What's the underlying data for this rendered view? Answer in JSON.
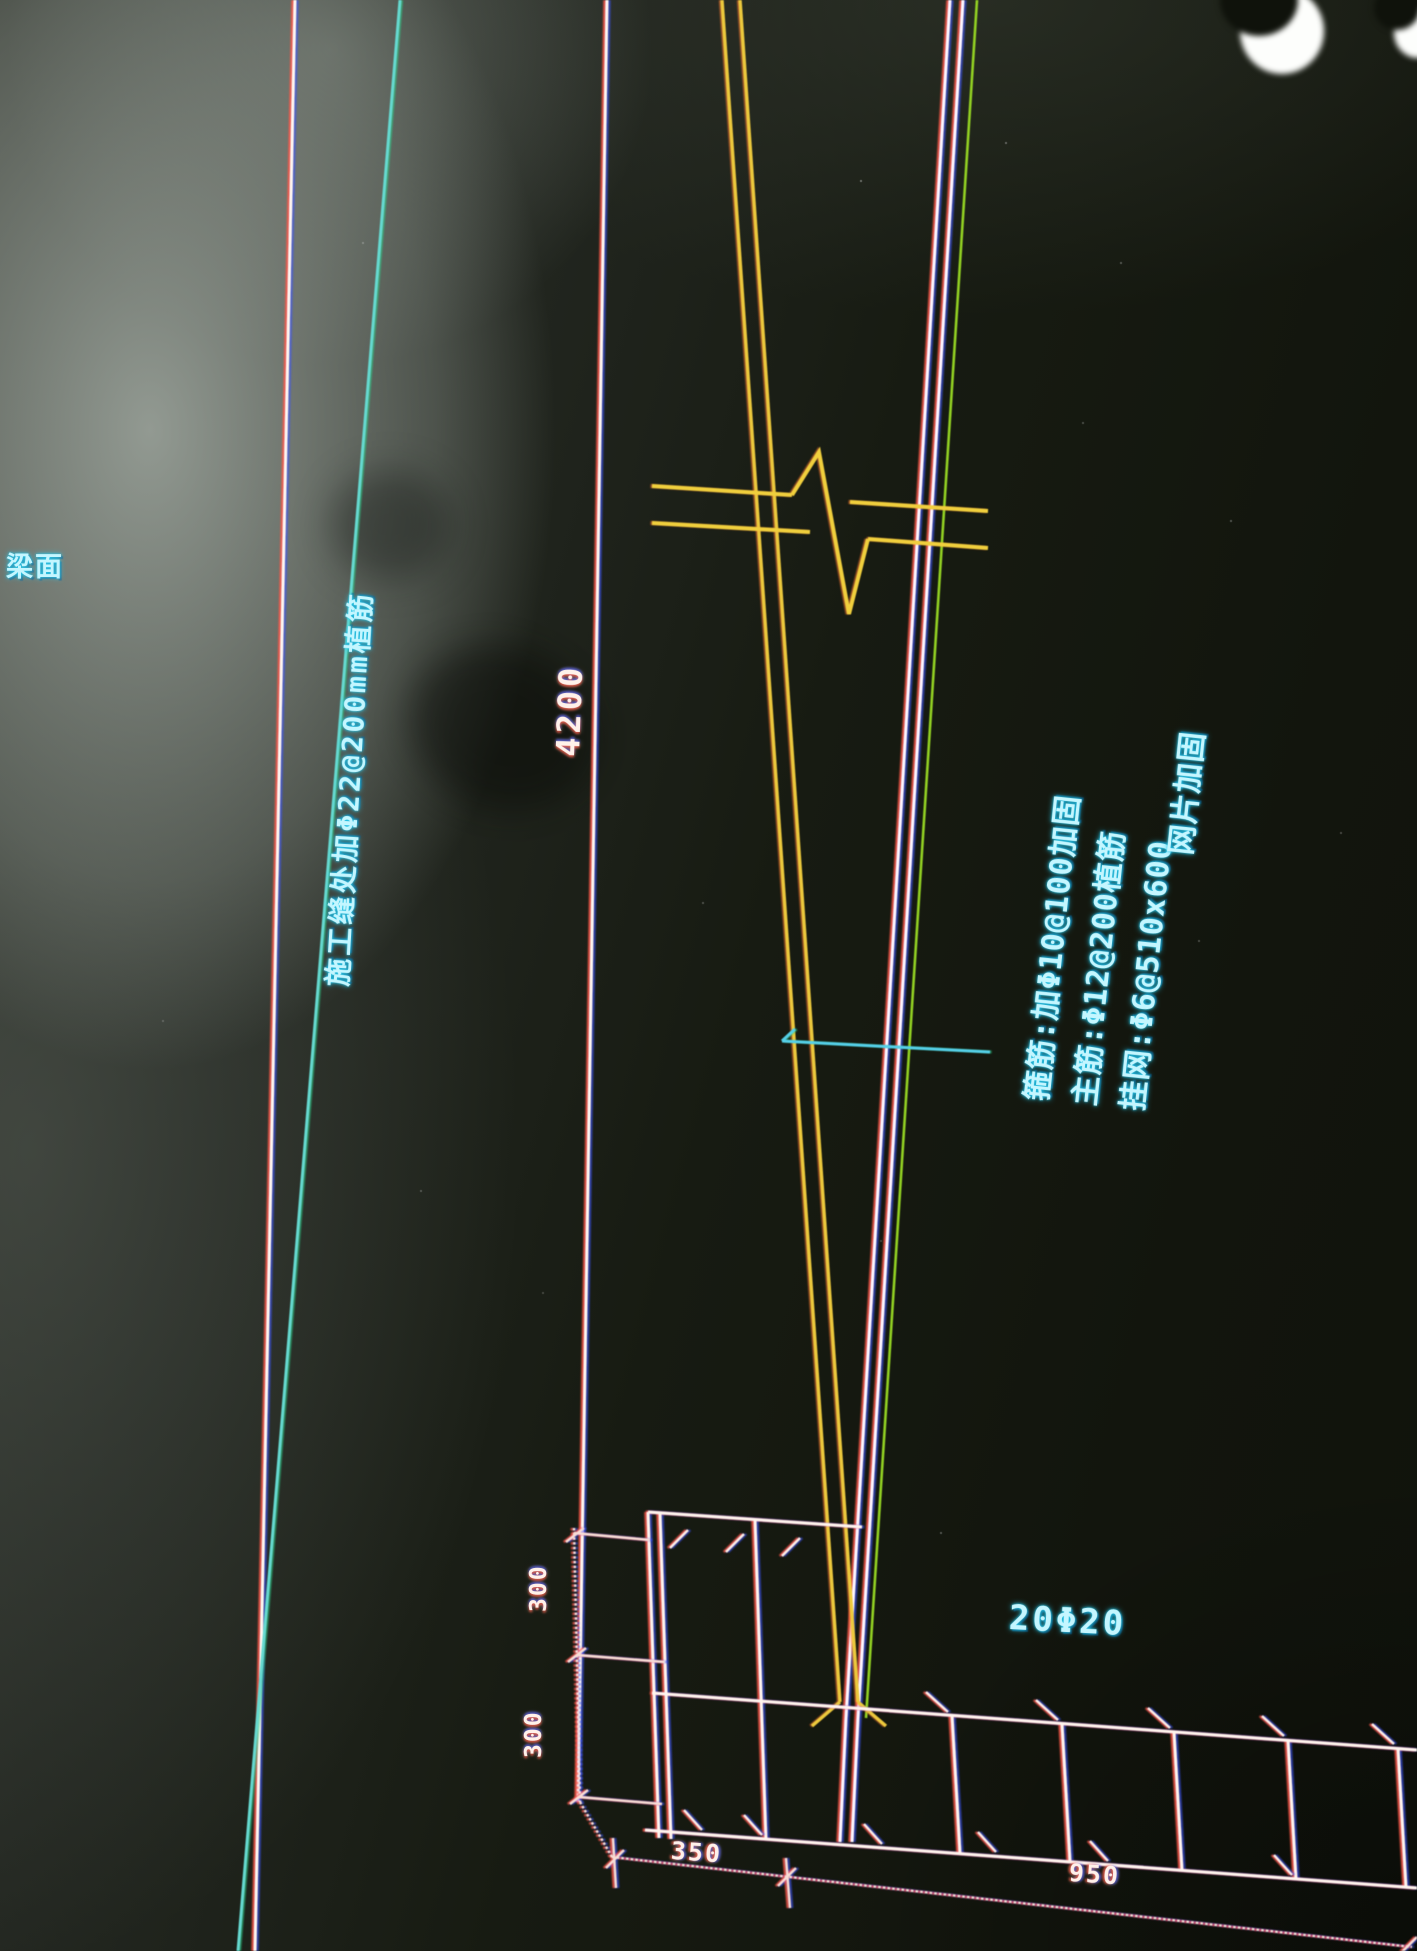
{
  "scene": {
    "description": "Photograph of a CAD screen showing a column-to-footing reinforcement strengthening detail",
    "colors": {
      "cad_cyan": "#55d8ec",
      "cad_yellow": "#eec93c",
      "cad_green": "#8cd22a",
      "cad_white": "#fff3ec",
      "dim_pink": "#f6dcd4",
      "screen_glare": "#9aa39b"
    }
  },
  "labels": {
    "surface_label": "梁面",
    "left_note": "施工缝处加Φ22@200mm植筋",
    "rebar_count_label": "20Φ20",
    "notes": {
      "line1": "箍筋:加Φ10@100加固",
      "line2": "主筋:Φ12@200植筋",
      "line3": "挂网:Φ6@510x600",
      "line4": "网片加固"
    }
  },
  "dimensions": {
    "column_height": "4200",
    "step_top": "300",
    "step_bottom": "300",
    "bottom_seg1": "350",
    "bottom_seg2": "950"
  }
}
